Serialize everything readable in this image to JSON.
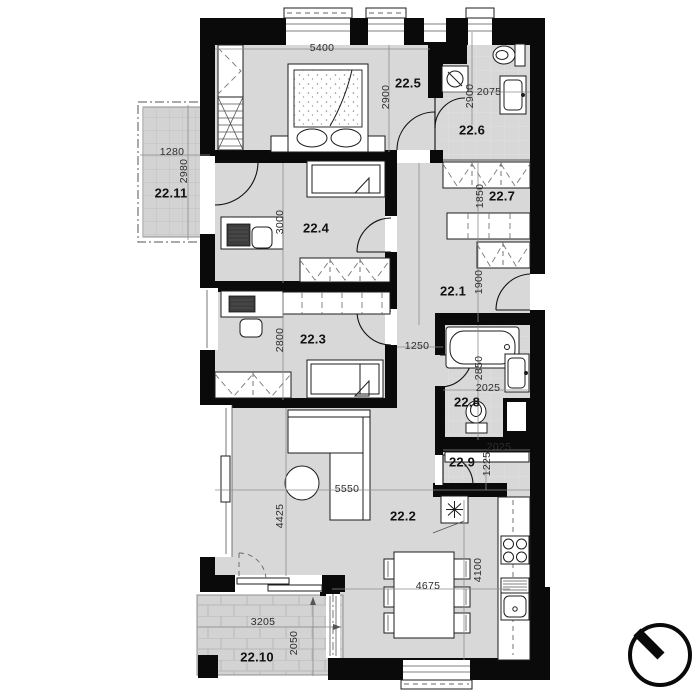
{
  "plan": {
    "title": "apartment floor plan",
    "unit": "mm",
    "rooms": [
      {
        "label": "22.1"
      },
      {
        "label": "22.2"
      },
      {
        "label": "22.3"
      },
      {
        "label": "22.4"
      },
      {
        "label": "22.5"
      },
      {
        "label": "22.6"
      },
      {
        "label": "22.7"
      },
      {
        "label": "22.8"
      },
      {
        "label": "22.9"
      },
      {
        "label": "22.10"
      },
      {
        "label": "22.11"
      }
    ],
    "dimensions": [
      {
        "value": "5400",
        "room": "22.5"
      },
      {
        "value": "2900",
        "room": "22.5"
      },
      {
        "value": "2900",
        "room": "22.6"
      },
      {
        "value": "2075",
        "room": "22.6"
      },
      {
        "value": "1280",
        "room": "22.11"
      },
      {
        "value": "2980",
        "room": "22.11"
      },
      {
        "value": "3000",
        "room": "22.4"
      },
      {
        "value": "1850",
        "room": "22.7"
      },
      {
        "value": "1900",
        "room": "22.1"
      },
      {
        "value": "2800",
        "room": "22.3"
      },
      {
        "value": "1250",
        "room": "22.1"
      },
      {
        "value": "2850",
        "room": "22.8"
      },
      {
        "value": "2025",
        "room": "22.8"
      },
      {
        "value": "2025",
        "room": "22.9"
      },
      {
        "value": "1225",
        "room": "22.9"
      },
      {
        "value": "5550",
        "room": "22.2"
      },
      {
        "value": "4425",
        "room": "22.2"
      },
      {
        "value": "4675",
        "room": "22.2"
      },
      {
        "value": "4100",
        "room": "22.2"
      },
      {
        "value": "3205",
        "room": "22.10"
      },
      {
        "value": "2050",
        "room": "22.10"
      }
    ],
    "colors": {
      "wall": "#0a0a0a",
      "floor": "#d8d8d8",
      "outdoor": "#d3d3d3",
      "furniture_line": "#1c1c1c",
      "dimension_text": "#2e2e2e"
    },
    "icons": {
      "north_arrow": "compass-north-arrow",
      "fridge": "snowflake-icon"
    }
  }
}
